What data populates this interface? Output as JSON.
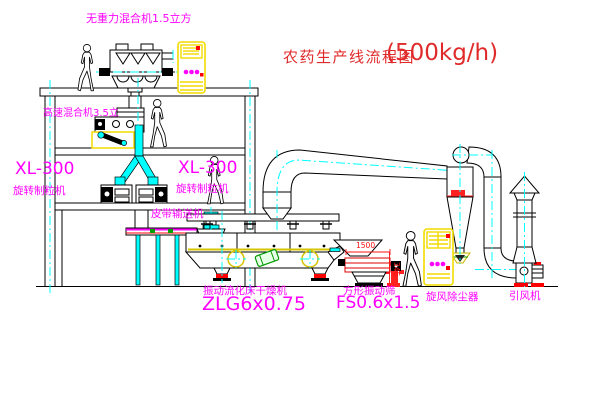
{
  "title": {
    "text": "农药生产线流程图",
    "capacity": "(500kg/h)"
  },
  "labels": {
    "zero_gravity_mixer": "无重力混合机1.5立方",
    "high_speed_mixer": "高速混合机3.5立",
    "granulator_left_model": "XL-300",
    "granulator_left_name": "旋转制粒机",
    "granulator_right_model": "XL-300",
    "granulator_right_name": "旋转制粒机",
    "belt_conveyor": "皮带输送机",
    "dryer_name": "振动流化床干燥机",
    "dryer_model": "ZLG6x0.75",
    "sieve_name": "方形振动筛",
    "sieve_model": "FS0.6x1.5",
    "cyclone": "旋风除尘器",
    "fan": "引风机"
  },
  "dimensions": {
    "sieve_length": "1500",
    "sieve_height": "346"
  },
  "colors": {
    "label_magenta": "#FF00FF",
    "title_red": "#E02A2A",
    "line_black": "#000000",
    "centerline_cyan": "#00FFFF",
    "cabinet_yellow": "#F2DC00",
    "accent_red": "#FF0000",
    "accent_green": "#009900",
    "background": "#FFFFFF"
  }
}
